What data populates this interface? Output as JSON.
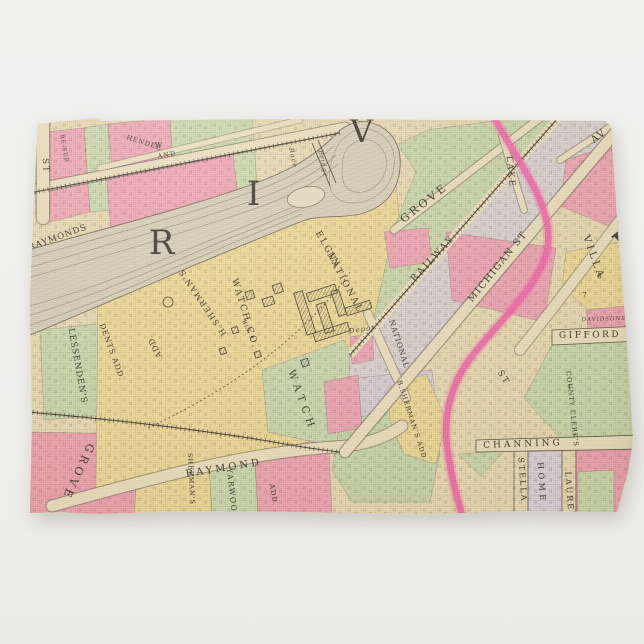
{
  "scene": {
    "type": "product-photo",
    "product": "kitchen towel printed with vintage plat map of Elgin",
    "background_color": "#f0f0ee"
  },
  "map": {
    "palette": {
      "paper": "#ebdab1",
      "block_pink": "#f1a5b3",
      "block_green": "#cbd8aa",
      "block_yellow": "#efd993",
      "block_lavender": "#dcd1d9",
      "highlight_road_pink": "#f263a5",
      "river_fill": "#d9cfb8",
      "ink": "#3c362b"
    },
    "river_word": "RIVER",
    "labels": [
      {
        "id": "river-letter-r",
        "text": "R"
      },
      {
        "id": "river-letter-i",
        "text": "I"
      },
      {
        "id": "river-letter-v",
        "text": "V"
      },
      {
        "id": "elgin",
        "text": "ELGIN"
      },
      {
        "id": "national-co",
        "text": "NATIONAL"
      },
      {
        "id": "watch-co",
        "text": "WATCH CO."
      },
      {
        "id": "h-shermans",
        "text": "H.SHERMAN'S"
      },
      {
        "id": "add-campus",
        "text": "ADD."
      },
      {
        "id": "blk-1",
        "text": "BLK 1"
      },
      {
        "id": "raymond-street",
        "text": "RAYMOND"
      },
      {
        "id": "shermans-column",
        "text": "SHERMAN'S"
      },
      {
        "id": "yarwood",
        "text": "YARWOOD"
      },
      {
        "id": "add-bottom",
        "text": "ADD."
      },
      {
        "id": "grove-flipped",
        "text": "GROVE"
      },
      {
        "id": "raymonds",
        "text": "RAYMONDS"
      },
      {
        "id": "lessendens",
        "text": "LESSENDEN'S"
      },
      {
        "id": "dents-add",
        "text": "DENTS ADD."
      },
      {
        "id": "hendee",
        "text": "HENDEE"
      },
      {
        "id": "w",
        "text": "W"
      },
      {
        "id": "and",
        "text": "AND"
      },
      {
        "id": "race",
        "text": "Race"
      },
      {
        "id": "bridge",
        "text": "Bridge"
      },
      {
        "id": "depot",
        "text": "Depot"
      },
      {
        "id": "national-street",
        "text": "NATIONAL"
      },
      {
        "id": "grove-street",
        "text": "GROVE"
      },
      {
        "id": "lake-street",
        "text": "LAKE"
      },
      {
        "id": "railway",
        "text": "RAILWAY"
      },
      {
        "id": "michigan-street",
        "text": "MICHIGAN ST"
      },
      {
        "id": "villa",
        "text": "VILLA"
      },
      {
        "id": "av",
        "text": "AV"
      },
      {
        "id": "davidsons-sub",
        "text": "DAVIDSONS SUB"
      },
      {
        "id": "gifford",
        "text": "GIFFORD"
      },
      {
        "id": "county-clerks",
        "text": "COUNTY CLERK'S"
      },
      {
        "id": "b-shermans-add",
        "text": "B.SHERMAN'S ADD."
      },
      {
        "id": "channing",
        "text": "CHANNING"
      },
      {
        "id": "stella",
        "text": "STELLA"
      },
      {
        "id": "home",
        "text": "HOME"
      },
      {
        "id": "laurel",
        "text": "LAUREL"
      },
      {
        "id": "watch-strip",
        "text": "WATCH"
      },
      {
        "id": "st-left",
        "text": "ST"
      },
      {
        "id": "st-villa",
        "text": "ST"
      },
      {
        "id": "re-sub",
        "text": "RE-SUB"
      },
      {
        "id": "num-8",
        "text": "8"
      },
      {
        "id": "num-7",
        "text": "7"
      },
      {
        "id": "num-1",
        "text": "1"
      },
      {
        "id": "sheet-letter-fragment",
        "text": "I"
      }
    ]
  }
}
